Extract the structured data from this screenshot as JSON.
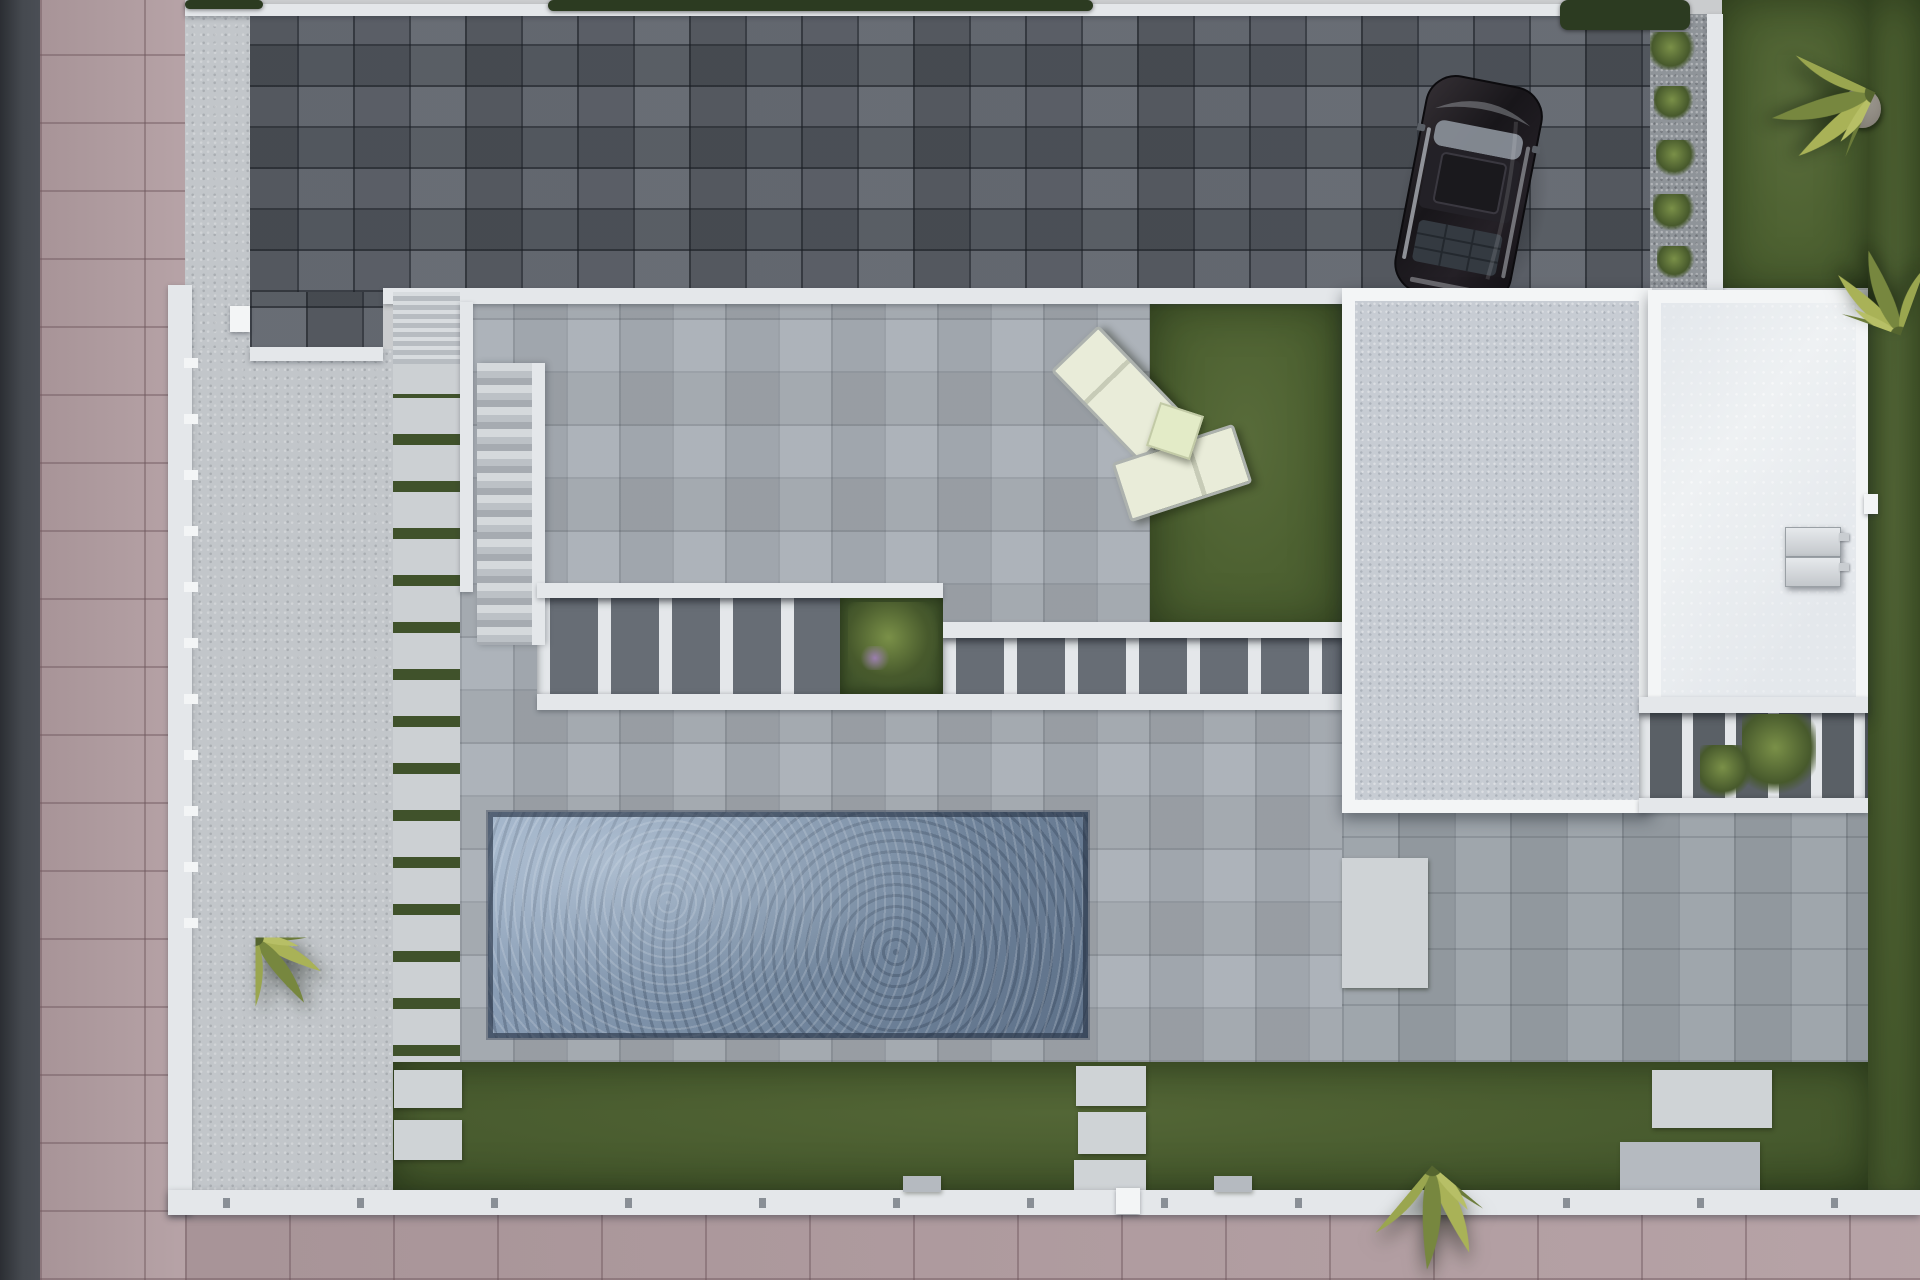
{
  "meta": {
    "description": "Top-down 3D architectural render of a modern villa plot: dark paver driveway with parked black SUV, white perimeter walls, concrete terraces, slatted pergolas, rectangular pool, artificial lawns, stepping-stone paths, flat white roofs with AC units, palm trees, pink street sidewalk at left and bottom."
  },
  "palette": {
    "road": "#45494f",
    "road_edge": "#2b2e33",
    "pink": "#b29da1",
    "wall": "#e4e7ea",
    "wall_bright": "#f3f5f6",
    "paver": "#575c64",
    "concrete": "#c2c6ca",
    "walkway": "#ccd0d3",
    "joint": "#40522b",
    "terrace": "#a6acb3",
    "terrace2": "#9aa1a8",
    "lawn": "#4d6131",
    "lawn_dark": "#46592d",
    "pool_deep": "#64788f",
    "pool_light": "#93a7bf",
    "slab": "#c7ccd3",
    "roof": "#eef1f3",
    "gap": "#676d75",
    "gap2": "#5a6066",
    "shrub_hi": "#7a9048",
    "shrub_lo": "#47592c",
    "palm_hi": "#a9b257",
    "palm_lo": "#6b7b39",
    "stone": "#cfd3d6",
    "pad": "#b5bac0",
    "gravel": "#8f9499",
    "rock_hi": "#b5b0a8",
    "rock_lo": "#7b766d",
    "cushion": "#e9ecd9",
    "cushion_frame": "#adb2ae",
    "hedge": "#2c3b21"
  },
  "scene": {
    "width": 1920,
    "height": 1280,
    "elements": [
      {
        "name": "street-road",
        "cls": "road",
        "x": 0,
        "y": 0,
        "w": 40,
        "h": 1280,
        "z": 1
      },
      {
        "name": "sidewalk-left",
        "cls": "sidewalk",
        "x": 40,
        "y": 0,
        "w": 145,
        "h": 1280,
        "z": 1
      },
      {
        "name": "driveway-pavers",
        "cls": "pavers",
        "x": 185,
        "y": 14,
        "w": 1465,
        "h": 278,
        "z": 2
      },
      {
        "name": "driveway-notch",
        "cls": "pavers",
        "x": 250,
        "y": 292,
        "w": 133,
        "h": 57,
        "z": 2
      },
      {
        "name": "lawn-top-right",
        "cls": "lawn",
        "x": 1722,
        "y": 0,
        "w": 146,
        "h": 292,
        "z": 2
      },
      {
        "name": "lawn-right-strip",
        "cls": "lawn",
        "x": 1868,
        "y": 0,
        "w": 52,
        "h": 1213,
        "z": 2
      },
      {
        "name": "terrace-main",
        "cls": "terrace",
        "x": 460,
        "y": 302,
        "w": 882,
        "h": 760,
        "z": 2
      },
      {
        "name": "terrace-right",
        "cls": "terrace2",
        "x": 1342,
        "y": 812,
        "w": 526,
        "h": 250,
        "z": 2
      },
      {
        "name": "side-yard-concrete",
        "cls": "concrete",
        "x": 192,
        "y": 349,
        "w": 201,
        "h": 841,
        "z": 2
      },
      {
        "name": "driveway-apron",
        "cls": "concrete",
        "x": 185,
        "y": 14,
        "w": 65,
        "h": 335,
        "z": 3
      },
      {
        "name": "top-boundary-wall",
        "cls": "wall",
        "x": 185,
        "y": 4,
        "w": 1465,
        "h": 12,
        "z": 3
      },
      {
        "name": "walkway-green-joints",
        "cls": "walkway",
        "x": 393,
        "y": 364,
        "w": 67,
        "h": 698,
        "z": 3
      },
      {
        "name": "courtyard-lawn",
        "cls": "lawn",
        "x": 1150,
        "y": 302,
        "w": 192,
        "h": 326,
        "z": 3
      },
      {
        "name": "bottom-lawn",
        "cls": "lawn-b",
        "x": 393,
        "y": 1062,
        "w": 1475,
        "h": 128,
        "z": 3
      },
      {
        "name": "pergola-openings-left",
        "cls": "pergola",
        "x": 537,
        "y": 598,
        "w": 406,
        "h": 96,
        "z": 3
      },
      {
        "name": "pergola-openings-right",
        "cls": "pergola",
        "x": 943,
        "y": 638,
        "w": 399,
        "h": 57,
        "z": 3
      },
      {
        "name": "sidewalk-bottom",
        "cls": "sidewalk",
        "x": 185,
        "y": 1213,
        "w": 1735,
        "h": 67,
        "z": 3
      },
      {
        "name": "planter-gravel-strip",
        "cls": "gravel",
        "x": 1650,
        "y": 14,
        "w": 57,
        "h": 278,
        "z": 3
      },
      {
        "name": "car-shadow",
        "cls": "car-shadow",
        "x": 1398,
        "y": 86,
        "w": 150,
        "h": 235,
        "z": 3,
        "rot": 11
      },
      {
        "name": "outer-wall-left",
        "cls": "wall",
        "x": 168,
        "y": 285,
        "w": 24,
        "h": 930,
        "z": 4
      },
      {
        "name": "left-wall-posts",
        "cls": "posts",
        "x": 184,
        "y": 358,
        "w": 14,
        "h": 590,
        "z": 4
      },
      {
        "name": "courtyard-top-wall",
        "cls": "wall",
        "x": 383,
        "y": 288,
        "w": 1485,
        "h": 16,
        "z": 4
      },
      {
        "name": "notch-bottom-wall",
        "cls": "wall",
        "x": 250,
        "y": 347,
        "w": 133,
        "h": 14,
        "z": 4
      },
      {
        "name": "entry-stairs",
        "cls": "stairs-sm",
        "x": 393,
        "y": 292,
        "w": 67,
        "h": 72,
        "z": 4
      },
      {
        "name": "courtyard-left-wall",
        "cls": "wall",
        "x": 460,
        "y": 302,
        "w": 13,
        "h": 290,
        "z": 4
      },
      {
        "name": "long-staircase",
        "cls": "stairs",
        "x": 477,
        "y": 363,
        "w": 55,
        "h": 282,
        "z": 4
      },
      {
        "name": "pergola-top-band-left",
        "cls": "wall",
        "x": 537,
        "y": 583,
        "w": 406,
        "h": 15,
        "z": 4
      },
      {
        "name": "pergola-top-band-right",
        "cls": "wall",
        "x": 943,
        "y": 622,
        "w": 399,
        "h": 16,
        "z": 4
      },
      {
        "name": "pergola-bottom-band",
        "cls": "wall",
        "x": 537,
        "y": 694,
        "w": 805,
        "h": 16,
        "z": 4
      },
      {
        "name": "pergola-planter-grass",
        "cls": "planter-grass",
        "x": 840,
        "y": 598,
        "w": 103,
        "h": 96,
        "z": 4
      },
      {
        "name": "swimming-pool",
        "cls": "pool",
        "x": 488,
        "y": 812,
        "w": 600,
        "h": 226,
        "z": 4
      },
      {
        "name": "walkway-stone-1",
        "cls": "stone",
        "x": 394,
        "y": 1070,
        "w": 68,
        "h": 38,
        "z": 4
      },
      {
        "name": "walkway-stone-2",
        "cls": "stone",
        "x": 394,
        "y": 1120,
        "w": 68,
        "h": 40,
        "z": 4
      },
      {
        "name": "center-stone-1",
        "cls": "stone",
        "x": 1076,
        "y": 1066,
        "w": 70,
        "h": 40,
        "z": 4
      },
      {
        "name": "center-stone-2",
        "cls": "stone",
        "x": 1078,
        "y": 1112,
        "w": 68,
        "h": 42,
        "z": 4
      },
      {
        "name": "center-stone-3",
        "cls": "stone",
        "x": 1074,
        "y": 1160,
        "w": 72,
        "h": 30,
        "z": 4
      },
      {
        "name": "right-lawn-stone",
        "cls": "stone",
        "x": 1652,
        "y": 1070,
        "w": 120,
        "h": 58,
        "z": 4
      },
      {
        "name": "right-entry-pad",
        "cls": "pad",
        "x": 1620,
        "y": 1142,
        "w": 140,
        "h": 48,
        "z": 4
      },
      {
        "name": "slab-side-pad",
        "cls": "stone",
        "x": 1342,
        "y": 858,
        "w": 86,
        "h": 130,
        "z": 4
      },
      {
        "name": "planter-wall-top-right",
        "cls": "wall",
        "x": 1707,
        "y": 14,
        "w": 16,
        "h": 278,
        "z": 4
      },
      {
        "name": "top-hedge",
        "cls": "hedge",
        "x": 548,
        "y": 0,
        "w": 545,
        "h": 11,
        "z": 4
      },
      {
        "name": "top-left-hedge",
        "cls": "hedge",
        "x": 185,
        "y": 0,
        "w": 78,
        "h": 9,
        "z": 4
      },
      {
        "name": "top-right-trees",
        "cls": "hedge",
        "x": 1560,
        "y": 0,
        "w": 130,
        "h": 30,
        "z": 4
      },
      {
        "name": "parked-car",
        "cls": "car",
        "x": 1406,
        "y": 78,
        "w": 125,
        "h": 225,
        "z": 4,
        "rot": 11,
        "svg": "sym-car",
        "vb": "0 0 125 225"
      },
      {
        "name": "garage-roof-frame",
        "cls": "frame",
        "x": 1342,
        "y": 288,
        "w": 310,
        "h": 525,
        "z": 5
      },
      {
        "name": "bottom-boundary-wall",
        "cls": "wall-bottom",
        "x": 168,
        "y": 1190,
        "w": 1752,
        "h": 25,
        "z": 5
      },
      {
        "name": "lawn-wall-block-1",
        "cls": "pad",
        "x": 903,
        "y": 1176,
        "w": 38,
        "h": 16,
        "z": 5
      },
      {
        "name": "lawn-wall-block-2",
        "cls": "pad",
        "x": 1214,
        "y": 1176,
        "w": 38,
        "h": 16,
        "z": 5
      },
      {
        "name": "gate-marker",
        "cls": "wall-bright",
        "x": 1116,
        "y": 1188,
        "w": 24,
        "h": 26,
        "z": 5
      },
      {
        "name": "left-wall-cap",
        "cls": "wall-bright",
        "x": 230,
        "y": 306,
        "w": 20,
        "h": 26,
        "z": 5
      },
      {
        "name": "sun-lounger-1",
        "cls": "lounger-v",
        "x": 1086,
        "y": 330,
        "w": 60,
        "h": 122,
        "z": 5,
        "rot": -44
      },
      {
        "name": "sun-lounger-2",
        "cls": "lounger-h",
        "x": 1118,
        "y": 442,
        "w": 122,
        "h": 56,
        "z": 5,
        "rot": -18
      },
      {
        "name": "lounger-side-table",
        "cls": "side-table",
        "x": 1152,
        "y": 408,
        "w": 42,
        "h": 42,
        "z": 5,
        "rot": 18
      },
      {
        "name": "garage-roof-slab",
        "cls": "slab",
        "x": 1355,
        "y": 301,
        "w": 284,
        "h": 499,
        "z": 6
      },
      {
        "name": "house-roof-frame",
        "cls": "frame",
        "x": 1648,
        "y": 290,
        "w": 220,
        "h": 424,
        "z": 6
      },
      {
        "name": "right-pergola-openings",
        "cls": "pergola2",
        "x": 1639,
        "y": 713,
        "w": 229,
        "h": 85,
        "z": 6
      },
      {
        "name": "garden-rock",
        "cls": "rock",
        "x": 1843,
        "y": 88,
        "w": 38,
        "h": 40,
        "z": 6
      },
      {
        "name": "house-roof-white",
        "cls": "roof-white",
        "x": 1661,
        "y": 303,
        "w": 195,
        "h": 399,
        "z": 7
      },
      {
        "name": "right-pergola-top-band",
        "cls": "wall",
        "x": 1639,
        "y": 697,
        "w": 229,
        "h": 16,
        "z": 7
      },
      {
        "name": "right-pergola-bottom-band",
        "cls": "wall",
        "x": 1639,
        "y": 798,
        "w": 229,
        "h": 15,
        "z": 7
      },
      {
        "name": "ac-unit-1",
        "cls": "ac",
        "x": 1785,
        "y": 527,
        "w": 54,
        "h": 28,
        "z": 8
      },
      {
        "name": "ac-unit-2",
        "cls": "ac",
        "x": 1785,
        "y": 557,
        "w": 54,
        "h": 28,
        "z": 8
      },
      {
        "name": "ac-tab-1",
        "cls": "ac-tab",
        "x": 1839,
        "y": 533,
        "w": 10,
        "h": 8,
        "z": 8
      },
      {
        "name": "ac-tab-2",
        "cls": "ac-tab",
        "x": 1839,
        "y": 563,
        "w": 10,
        "h": 8,
        "z": 8
      },
      {
        "name": "roof-edge-tab",
        "cls": "wall-bright",
        "x": 1864,
        "y": 494,
        "w": 14,
        "h": 20,
        "z": 8
      },
      {
        "name": "planter-shrub-1",
        "cls": "shrub",
        "x": 1650,
        "y": 32,
        "w": 46,
        "h": 38,
        "z": 7
      },
      {
        "name": "planter-shrub-2",
        "cls": "shrub",
        "x": 1654,
        "y": 86,
        "w": 40,
        "h": 34,
        "z": 7
      },
      {
        "name": "planter-shrub-3",
        "cls": "shrub",
        "x": 1656,
        "y": 140,
        "w": 40,
        "h": 36,
        "z": 7
      },
      {
        "name": "planter-shrub-4",
        "cls": "shrub",
        "x": 1653,
        "y": 194,
        "w": 42,
        "h": 36,
        "z": 7
      },
      {
        "name": "planter-shrub-5",
        "cls": "shrub",
        "x": 1657,
        "y": 246,
        "w": 38,
        "h": 32,
        "z": 7
      },
      {
        "name": "right-pergola-shrub-1",
        "cls": "shrub",
        "x": 1742,
        "y": 714,
        "w": 74,
        "h": 84,
        "z": 7
      },
      {
        "name": "right-pergola-shrub-2",
        "cls": "shrub",
        "x": 1700,
        "y": 745,
        "w": 50,
        "h": 56,
        "z": 7
      },
      {
        "name": "pergola-planter-palm",
        "cls": "shrub",
        "x": 848,
        "y": 602,
        "w": 90,
        "h": 88,
        "z": 7
      },
      {
        "name": "pergola-planter-flowers",
        "cls": "flower",
        "x": 858,
        "y": 646,
        "w": 34,
        "h": 24,
        "z": 8
      },
      {
        "name": "palm-bottom-left",
        "cls": "palm",
        "x": 163,
        "y": 845,
        "w": 185,
        "h": 185,
        "z": 9,
        "svg": "sym-palm",
        "vb": "-100 -100 200 200"
      },
      {
        "name": "palm-bottom-right",
        "cls": "palm",
        "x": 1312,
        "y": 1048,
        "w": 240,
        "h": 235,
        "z": 9,
        "svg": "sym-palm",
        "vb": "-100 -100 200 200",
        "rot": 40
      },
      {
        "name": "palm-top-right-1",
        "cls": "palm",
        "x": 1748,
        "y": -25,
        "w": 255,
        "h": 235,
        "z": 9,
        "svg": "sym-palm",
        "vb": "-100 -100 200 200",
        "rot": 115
      },
      {
        "name": "palm-top-right-2",
        "cls": "palm",
        "x": 1788,
        "y": 238,
        "w": 225,
        "h": 195,
        "z": 9,
        "svg": "sym-palm",
        "vb": "-100 -100 200 200",
        "rot": 200
      }
    ]
  }
}
